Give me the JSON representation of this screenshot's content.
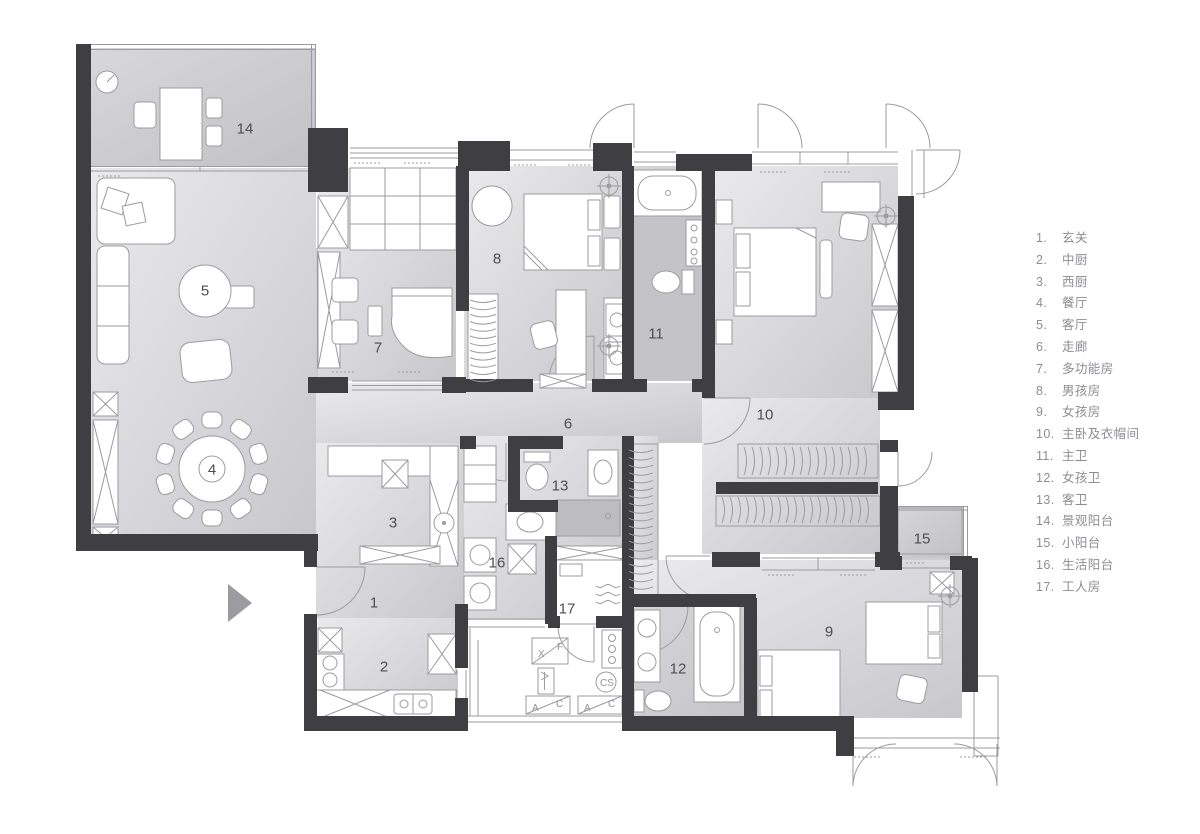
{
  "colors": {
    "wall": "#3f3f43",
    "floor_light": "#e9e9ec",
    "floor_dark": "#c9c9cd",
    "wet_floor": "#bcbcc1",
    "line": "#9b9ba1",
    "room_label": "#4d4d53",
    "legend_text": "#8d8d94",
    "entrance_arrow": "#9b9ba0"
  },
  "plan": {
    "room_numbers": [
      {
        "n": "1",
        "x": 374,
        "y": 603
      },
      {
        "n": "2",
        "x": 384,
        "y": 667
      },
      {
        "n": "3",
        "x": 393,
        "y": 523
      },
      {
        "n": "4",
        "x": 212,
        "y": 470
      },
      {
        "n": "5",
        "x": 205,
        "y": 291
      },
      {
        "n": "6",
        "x": 568,
        "y": 424
      },
      {
        "n": "7",
        "x": 378,
        "y": 348
      },
      {
        "n": "8",
        "x": 497,
        "y": 259
      },
      {
        "n": "9",
        "x": 829,
        "y": 632
      },
      {
        "n": "10",
        "x": 765,
        "y": 415
      },
      {
        "n": "11",
        "x": 656,
        "y": 334
      },
      {
        "n": "12",
        "x": 678,
        "y": 669
      },
      {
        "n": "13",
        "x": 560,
        "y": 486
      },
      {
        "n": "14",
        "x": 245,
        "y": 129
      },
      {
        "n": "15",
        "x": 922,
        "y": 539
      },
      {
        "n": "16",
        "x": 497,
        "y": 563
      },
      {
        "n": "17",
        "x": 567,
        "y": 609
      }
    ],
    "platform": {
      "xf": [
        "X",
        "F"
      ],
      "ac1": [
        "A",
        "C"
      ],
      "ac2": [
        "A",
        "C"
      ],
      "cs": "CS"
    }
  },
  "legend": {
    "items": [
      {
        "num": "1.",
        "label": "玄关"
      },
      {
        "num": "2.",
        "label": "中厨"
      },
      {
        "num": "3.",
        "label": "西厨"
      },
      {
        "num": "4.",
        "label": "餐厅"
      },
      {
        "num": "5.",
        "label": "客厅"
      },
      {
        "num": "6.",
        "label": "走廊"
      },
      {
        "num": "7.",
        "label": "多功能房"
      },
      {
        "num": "8.",
        "label": "男孩房"
      },
      {
        "num": "9.",
        "label": "女孩房"
      },
      {
        "num": "10.",
        "label": "主卧及衣帽间"
      },
      {
        "num": "11.",
        "label": "主卫"
      },
      {
        "num": "12.",
        "label": "女孩卫"
      },
      {
        "num": "13.",
        "label": "客卫"
      },
      {
        "num": "14.",
        "label": "景观阳台"
      },
      {
        "num": "15.",
        "label": "小阳台"
      },
      {
        "num": "16.",
        "label": "生活阳台"
      },
      {
        "num": "17.",
        "label": "工人房"
      }
    ]
  }
}
